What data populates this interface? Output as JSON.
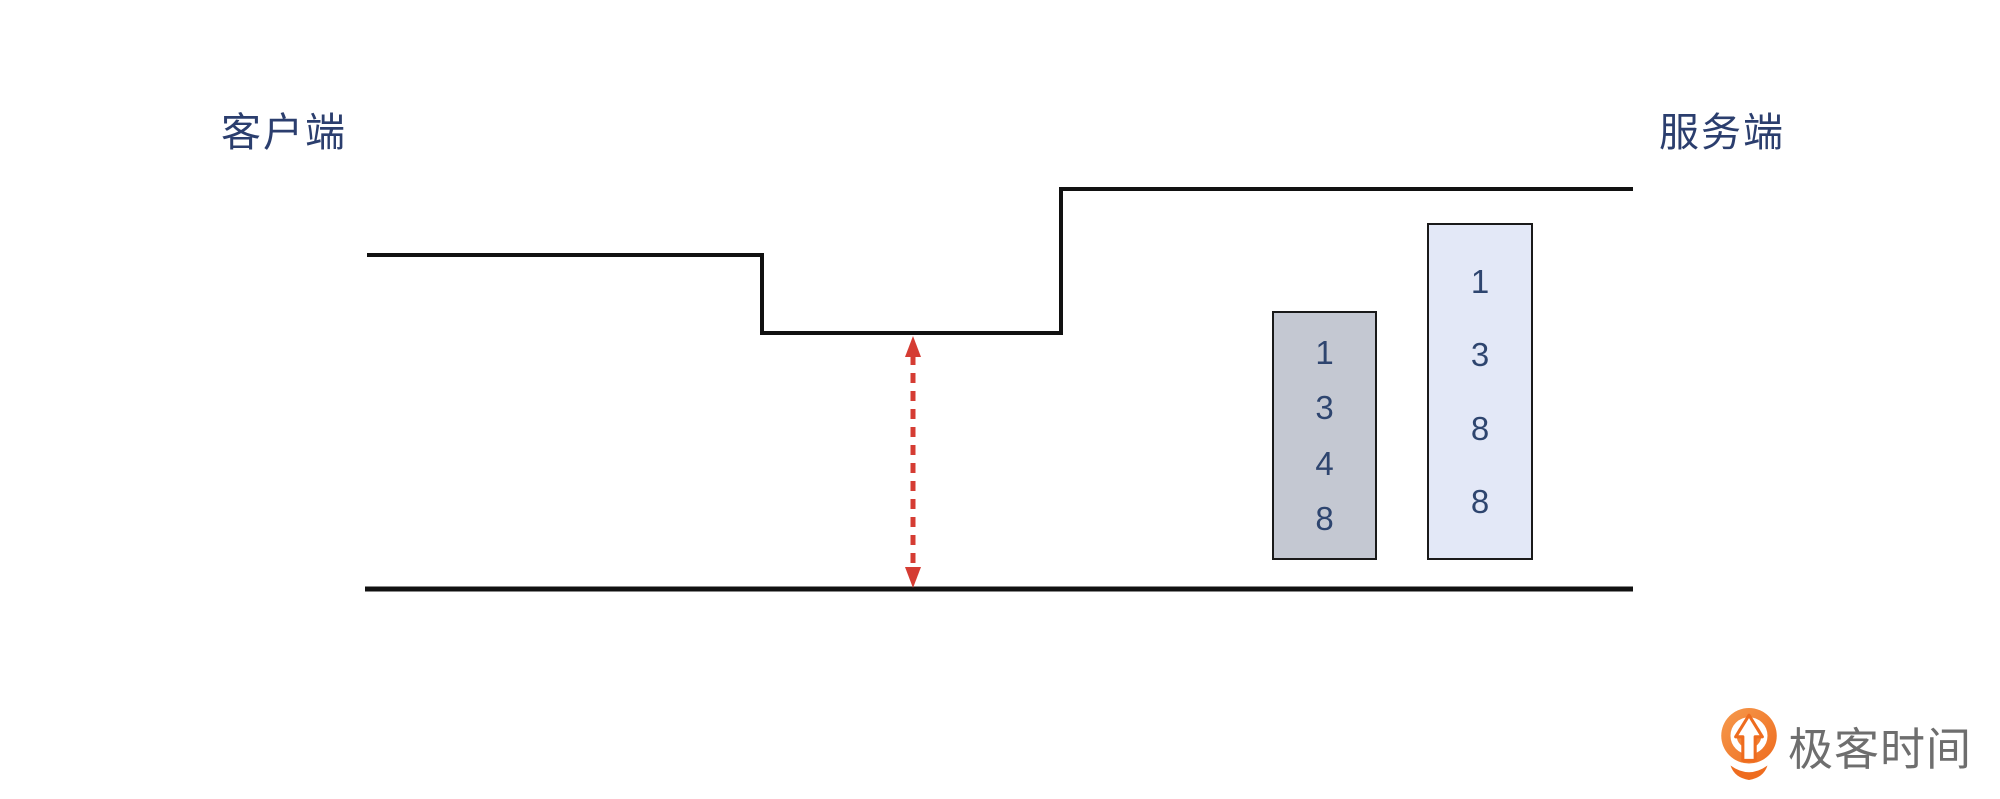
{
  "labels": {
    "client": "客户端",
    "server": "服务端"
  },
  "boxes": {
    "left": {
      "name": "sequence-numbers-1348",
      "digits": [
        "1",
        "3",
        "4",
        "8"
      ],
      "fill": "#c4c8d2"
    },
    "right": {
      "name": "sequence-numbers-1388",
      "digits": [
        "1",
        "3",
        "8",
        "8"
      ],
      "fill": "#e3e8f7"
    }
  },
  "brand": {
    "name": "极客时间"
  },
  "colors": {
    "line": "#111111",
    "box_border": "#1a1a1a",
    "label_text": "#2b3e6e",
    "digit_text": "#2e456f",
    "arrow_red": "#d53c33",
    "brand_text": "#6e6e6e",
    "brand_orange": "#ee6c1f",
    "brand_orange_light": "#f69a4d"
  }
}
